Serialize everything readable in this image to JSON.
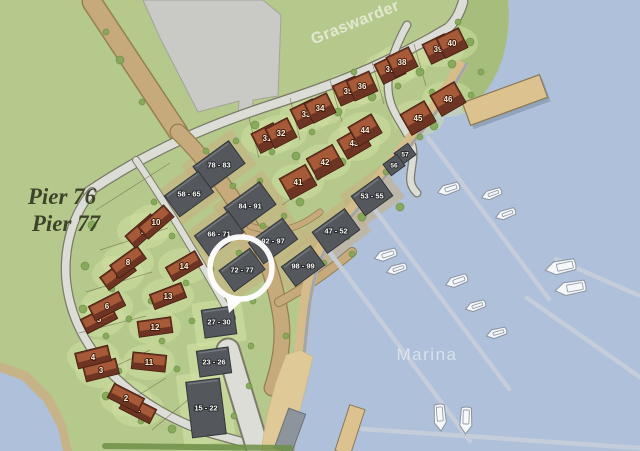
{
  "title": "Marina site plan",
  "labels": {
    "area_top": "Graswarder",
    "water": "Marina",
    "pier_line1": "Pier 76",
    "pier_line2": "Pier 77"
  },
  "highlight": {
    "label": "72 - 77",
    "x": 241,
    "y": 268,
    "r": 31
  },
  "houses": [
    {
      "num": "1",
      "x": 138,
      "y": 409,
      "a": 27,
      "w": 34,
      "h": 16
    },
    {
      "num": "2",
      "x": 126,
      "y": 398,
      "a": 27,
      "w": 34,
      "h": 16
    },
    {
      "num": "3",
      "x": 101,
      "y": 370,
      "a": -14,
      "w": 34,
      "h": 16
    },
    {
      "num": "4",
      "x": 93,
      "y": 357,
      "a": -14,
      "w": 34,
      "h": 16
    },
    {
      "num": "5",
      "x": 99,
      "y": 319,
      "a": -27,
      "w": 34,
      "h": 16
    },
    {
      "num": "6",
      "x": 107,
      "y": 306,
      "a": -27,
      "w": 34,
      "h": 16
    },
    {
      "num": "7",
      "x": 118,
      "y": 274,
      "a": -36,
      "w": 34,
      "h": 16
    },
    {
      "num": "8",
      "x": 128,
      "y": 262,
      "a": -36,
      "w": 34,
      "h": 16
    },
    {
      "num": "9",
      "x": 143,
      "y": 231,
      "a": -41,
      "w": 34,
      "h": 16
    },
    {
      "num": "10",
      "x": 156,
      "y": 222,
      "a": -41,
      "w": 34,
      "h": 16
    },
    {
      "num": "11",
      "x": 149,
      "y": 362,
      "a": 6,
      "w": 34,
      "h": 17
    },
    {
      "num": "12",
      "x": 155,
      "y": 327,
      "a": -8,
      "w": 34,
      "h": 16
    },
    {
      "num": "13",
      "x": 168,
      "y": 296,
      "a": -21,
      "w": 34,
      "h": 16
    },
    {
      "num": "14",
      "x": 184,
      "y": 266,
      "a": -30,
      "w": 34,
      "h": 16
    },
    {
      "num": "31",
      "x": 267,
      "y": 138,
      "a": -27,
      "w": 25,
      "h": 22
    },
    {
      "num": "32",
      "x": 281,
      "y": 133,
      "a": -27,
      "w": 25,
      "h": 22
    },
    {
      "num": "33",
      "x": 306,
      "y": 114,
      "a": -26,
      "w": 25,
      "h": 22
    },
    {
      "num": "34",
      "x": 320,
      "y": 108,
      "a": -26,
      "w": 25,
      "h": 22
    },
    {
      "num": "35",
      "x": 348,
      "y": 91,
      "a": -24,
      "w": 25,
      "h": 22
    },
    {
      "num": "36",
      "x": 362,
      "y": 86,
      "a": -24,
      "w": 25,
      "h": 22
    },
    {
      "num": "37",
      "x": 390,
      "y": 69,
      "a": -26,
      "w": 25,
      "h": 22
    },
    {
      "num": "38",
      "x": 402,
      "y": 62,
      "a": -26,
      "w": 25,
      "h": 22
    },
    {
      "num": "39",
      "x": 438,
      "y": 49,
      "a": -26,
      "w": 25,
      "h": 22
    },
    {
      "num": "40",
      "x": 452,
      "y": 43,
      "a": -26,
      "w": 25,
      "h": 22
    },
    {
      "num": "41",
      "x": 298,
      "y": 182,
      "a": -29,
      "w": 30,
      "h": 24
    },
    {
      "num": "42",
      "x": 325,
      "y": 162,
      "a": -29,
      "w": 30,
      "h": 24
    },
    {
      "num": "43",
      "x": 354,
      "y": 143,
      "a": -30,
      "w": 27,
      "h": 22
    },
    {
      "num": "44",
      "x": 365,
      "y": 130,
      "a": -30,
      "w": 27,
      "h": 22
    },
    {
      "num": "45",
      "x": 418,
      "y": 118,
      "a": -30,
      "w": 28,
      "h": 24
    },
    {
      "num": "46",
      "x": 448,
      "y": 99,
      "a": -30,
      "w": 28,
      "h": 24
    }
  ],
  "apartments": [
    {
      "label": "78 - 83",
      "x": 219,
      "y": 165,
      "a": -36,
      "w": 44,
      "h": 28
    },
    {
      "label": "58 - 65",
      "x": 189,
      "y": 194,
      "a": -36,
      "w": 42,
      "h": 26
    },
    {
      "label": "84 - 91",
      "x": 250,
      "y": 206,
      "a": -36,
      "w": 44,
      "h": 28
    },
    {
      "label": "66 - 71",
      "x": 219,
      "y": 234,
      "a": -36,
      "w": 42,
      "h": 26
    },
    {
      "label": "92 - 97",
      "x": 273,
      "y": 241,
      "a": -36,
      "w": 42,
      "h": 26
    },
    {
      "label": "72 - 77",
      "x": 242,
      "y": 270,
      "a": -36,
      "w": 38,
      "h": 26
    },
    {
      "label": "98 - 99",
      "x": 303,
      "y": 266,
      "a": -36,
      "w": 36,
      "h": 24
    },
    {
      "label": "47 - 52",
      "x": 336,
      "y": 231,
      "a": -36,
      "w": 40,
      "h": 26
    },
    {
      "label": "53 - 55",
      "x": 372,
      "y": 196,
      "a": -36,
      "w": 34,
      "h": 24
    },
    {
      "label": "27 - 30",
      "x": 219,
      "y": 322,
      "a": -8,
      "w": 32,
      "h": 28
    },
    {
      "label": "23 - 26",
      "x": 214,
      "y": 362,
      "a": -8,
      "w": 32,
      "h": 26
    },
    {
      "label": "15 - 22",
      "x": 206,
      "y": 408,
      "a": -7,
      "w": 34,
      "h": 56
    }
  ],
  "small_houses": [
    {
      "label": "57",
      "x": 405,
      "y": 154,
      "a": -36,
      "w": 17,
      "h": 14
    },
    {
      "label": "56",
      "x": 394,
      "y": 165,
      "a": -36,
      "w": 17,
      "h": 14
    }
  ],
  "boats": [
    {
      "x": 449,
      "y": 189,
      "a": 162,
      "l": 24
    },
    {
      "x": 492,
      "y": 194,
      "a": 160,
      "l": 22
    },
    {
      "x": 506,
      "y": 214,
      "a": 160,
      "l": 22
    },
    {
      "x": 386,
      "y": 255,
      "a": 162,
      "l": 24
    },
    {
      "x": 397,
      "y": 269,
      "a": 162,
      "l": 22
    },
    {
      "x": 457,
      "y": 281,
      "a": 160,
      "l": 24
    },
    {
      "x": 476,
      "y": 306,
      "a": 162,
      "l": 22
    },
    {
      "x": 497,
      "y": 333,
      "a": 164,
      "l": 22
    },
    {
      "x": 561,
      "y": 267,
      "a": 168,
      "l": 32
    },
    {
      "x": 571,
      "y": 288,
      "a": 170,
      "l": 32
    },
    {
      "x": 440,
      "y": 417,
      "a": 86,
      "l": 28
    },
    {
      "x": 466,
      "y": 420,
      "a": 92,
      "l": 28
    }
  ],
  "jetties": [
    [
      428,
      138,
      549,
      299
    ],
    [
      375,
      210,
      509,
      389
    ],
    [
      325,
      246,
      470,
      441
    ],
    [
      362,
      429,
      640,
      448
    ],
    [
      556,
      259,
      640,
      296
    ],
    [
      527,
      298,
      640,
      377
    ]
  ],
  "trees": [
    [
      255,
      125,
      4
    ],
    [
      272,
      152,
      3
    ],
    [
      296,
      156,
      4
    ],
    [
      312,
      132,
      3
    ],
    [
      338,
      112,
      4
    ],
    [
      354,
      72,
      3
    ],
    [
      372,
      97,
      4
    ],
    [
      398,
      86,
      3
    ],
    [
      420,
      72,
      4
    ],
    [
      432,
      92,
      3
    ],
    [
      452,
      64,
      4
    ],
    [
      300,
      202,
      4
    ],
    [
      318,
      177,
      3
    ],
    [
      342,
      162,
      4
    ],
    [
      362,
      217,
      4
    ],
    [
      347,
      237,
      3
    ],
    [
      386,
      172,
      3
    ],
    [
      400,
      207,
      4
    ],
    [
      420,
      137,
      3
    ],
    [
      434,
      126,
      4
    ],
    [
      302,
      257,
      3
    ],
    [
      324,
      263,
      3
    ],
    [
      352,
      254,
      3
    ],
    [
      92,
      225,
      4
    ],
    [
      85,
      266,
      4
    ],
    [
      112,
      289,
      3
    ],
    [
      83,
      309,
      4
    ],
    [
      106,
      336,
      3
    ],
    [
      91,
      353,
      4
    ],
    [
      119,
      371,
      3
    ],
    [
      106,
      396,
      4
    ],
    [
      141,
      421,
      3
    ],
    [
      172,
      429,
      4
    ],
    [
      197,
      431,
      3
    ],
    [
      129,
      319,
      3
    ],
    [
      151,
      301,
      3
    ],
    [
      162,
      341,
      3
    ],
    [
      177,
      369,
      3
    ],
    [
      192,
      321,
      3
    ],
    [
      154,
      202,
      3
    ],
    [
      172,
      236,
      3
    ],
    [
      186,
      283,
      3
    ],
    [
      206,
      151,
      3
    ],
    [
      236,
      141,
      3
    ],
    [
      233,
      186,
      3
    ],
    [
      260,
      181,
      3
    ],
    [
      263,
      226,
      3
    ],
    [
      239,
      253,
      3
    ],
    [
      211,
      269,
      3
    ],
    [
      284,
      216,
      3
    ],
    [
      291,
      263,
      3
    ],
    [
      286,
      336,
      3
    ],
    [
      251,
      346,
      3
    ],
    [
      249,
      386,
      3
    ],
    [
      234,
      416,
      3
    ],
    [
      253,
      301,
      3
    ],
    [
      120,
      60,
      4
    ],
    [
      142,
      102,
      3
    ],
    [
      106,
      32,
      3
    ],
    [
      470,
      42,
      4
    ],
    [
      481,
      72,
      3
    ],
    [
      458,
      22,
      3
    ],
    [
      471,
      95,
      3
    ]
  ],
  "fences": [
    [
      96,
      210,
      170,
      163
    ],
    [
      100,
      250,
      168,
      228
    ],
    [
      86,
      292,
      152,
      272
    ],
    [
      79,
      333,
      146,
      316
    ],
    [
      94,
      376,
      150,
      350
    ],
    [
      118,
      408,
      166,
      378
    ],
    [
      152,
      430,
      190,
      398
    ],
    [
      249,
      118,
      259,
      158
    ],
    [
      290,
      98,
      300,
      140
    ],
    [
      330,
      80,
      342,
      122
    ],
    [
      372,
      62,
      384,
      104
    ],
    [
      414,
      44,
      426,
      86
    ],
    [
      282,
      205,
      312,
      184
    ],
    [
      312,
      184,
      342,
      164
    ]
  ],
  "colors": {
    "grass": "#b6c98d",
    "shoreGreen": "#a6bd7c",
    "water": "#aec0da",
    "sand": "#dfc997",
    "sandEdge": "#c6b488",
    "roadFill": "#dcddd6",
    "roadEdge": "#7b7b68",
    "tanRoad": "#c7aa7c",
    "tanEdge": "#93804f",
    "parking": "#c9cac5",
    "parkingEdge": "#a3a399",
    "building": "#54585c",
    "buildingEdge": "#33363a",
    "pad": "#c9ae80",
    "houseDark": "#6e3423",
    "houseLight": "#a65a38",
    "houseEdge": "#421d0e",
    "numColor": "#ffeeda",
    "labelColor": "#f7f7f4",
    "jetty": "#c6ced9",
    "boatFill": "#f5f7f9",
    "boatEdge": "#8a93a0",
    "pier": "#dcc28e",
    "pierEdge": "#8a7a55",
    "ramp": "#8e949b",
    "glow": "#d3e2a5",
    "tree": "#84a756",
    "treeEdge": "#6e9148",
    "fence": "#6f6a4a",
    "ring": "#ffffff",
    "seawall": "#9aa3ac",
    "promenade": "#d6bc8a",
    "textOlive": "#3e4429",
    "textWaterLabel": "rgba(226,231,240,0.85)",
    "textAreaLabel": "rgba(238,240,230,0.78)"
  }
}
